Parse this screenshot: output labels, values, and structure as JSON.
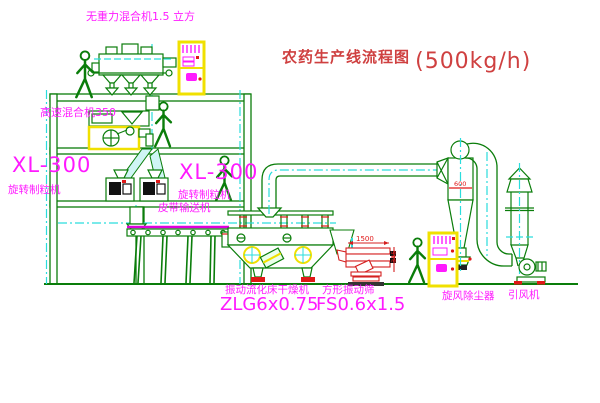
{
  "title": {
    "text": "农药生产线流程图",
    "capacity": "(500kg/h)"
  },
  "labels": {
    "gravity_free_mixer": "无重力混合机1.5 立方",
    "high_speed_mixer": "高速混合机350",
    "granulator_model_left": "XL-300",
    "granulator_name_left": "旋转制粒机",
    "granulator_model_mid": "XL-300",
    "granulator_name_mid": "旋转制粒机",
    "belt_conveyor": "皮带输送机",
    "dryer_name": "振动流化床干燥机",
    "dryer_model": "ZLG6x0.75",
    "sieve_name": "方形振动筛",
    "sieve_model": "FS0.6x1.5",
    "cyclone": "旋风除尘器",
    "fan": "引风机"
  },
  "dimensions": {
    "sieve_length": "1500",
    "sieve_height": "345",
    "cyclone_dia": "600"
  },
  "colors": {
    "line_green": "#0a7d0a",
    "centerline_cyan": "#2adddd",
    "label_magenta": "#ff1aff",
    "title_red": "#cf4040",
    "dim_red": "#e01818",
    "cabinet_yellow": "#f0e000",
    "belt_magenta": "#dd00dd"
  }
}
